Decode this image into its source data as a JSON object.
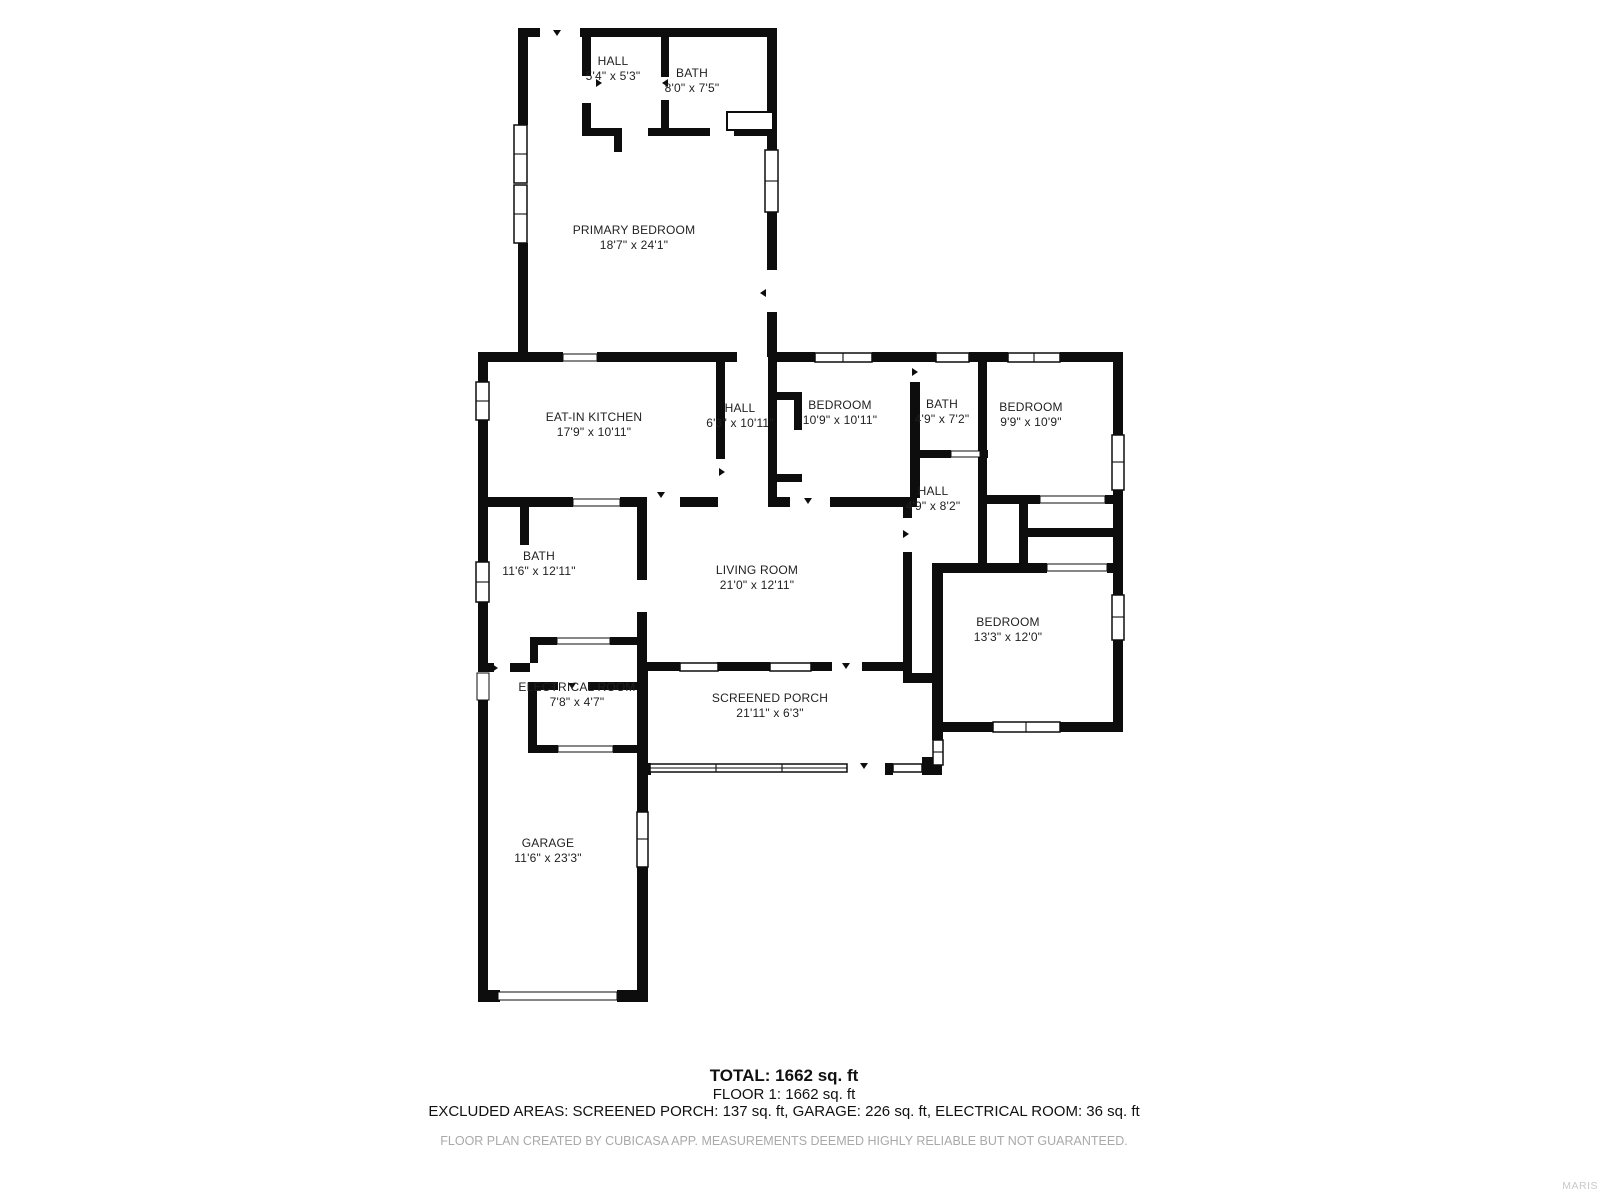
{
  "plan": {
    "rooms": [
      {
        "name": "HALL",
        "dims": "5'4\" x 5'3\""
      },
      {
        "name": "BATH",
        "dims": "8'0\" x 7'5\""
      },
      {
        "name": "PRIMARY BEDROOM",
        "dims": "18'7\" x 24'1\""
      },
      {
        "name": "EAT-IN KITCHEN",
        "dims": "17'9\" x 10'11\""
      },
      {
        "name": "HALL",
        "dims": "6'3\" x 10'11\""
      },
      {
        "name": "BEDROOM",
        "dims": "10'9\" x 10'11\""
      },
      {
        "name": "BATH",
        "dims": "4'9\" x 7'2\""
      },
      {
        "name": "BEDROOM",
        "dims": "9'9\" x 10'9\""
      },
      {
        "name": "HALL",
        "dims": "4'9\" x 8'2\""
      },
      {
        "name": "BATH",
        "dims": "11'6\" x 12'11\""
      },
      {
        "name": "LIVING ROOM",
        "dims": "21'0\" x 12'11\""
      },
      {
        "name": "BEDROOM",
        "dims": "13'3\" x 12'0\""
      },
      {
        "name": "ELECTRICAL ROOM",
        "dims": "7'8\" x 4'7\""
      },
      {
        "name": "SCREENED PORCH",
        "dims": "21'11\" x 6'3\""
      },
      {
        "name": "GARAGE",
        "dims": "11'6\" x 23'3\""
      }
    ]
  },
  "summary": {
    "total": "TOTAL: 1662 sq. ft",
    "floor": "FLOOR 1: 1662 sq. ft",
    "excluded": "EXCLUDED AREAS: SCREENED PORCH: 137 sq. ft, GARAGE: 226 sq. ft, ELECTRICAL ROOM: 36 sq. ft"
  },
  "disclaimer": "FLOOR PLAN CREATED BY CUBICASA APP. MEASUREMENTS DEEMED HIGHLY RELIABLE BUT NOT GUARANTEED.",
  "watermark": "MARIS",
  "colors": {
    "wall": "#0d0d0d",
    "text": "#1f1f1f",
    "muted": "#a9a9a9",
    "watermark": "#c9c9c9"
  }
}
